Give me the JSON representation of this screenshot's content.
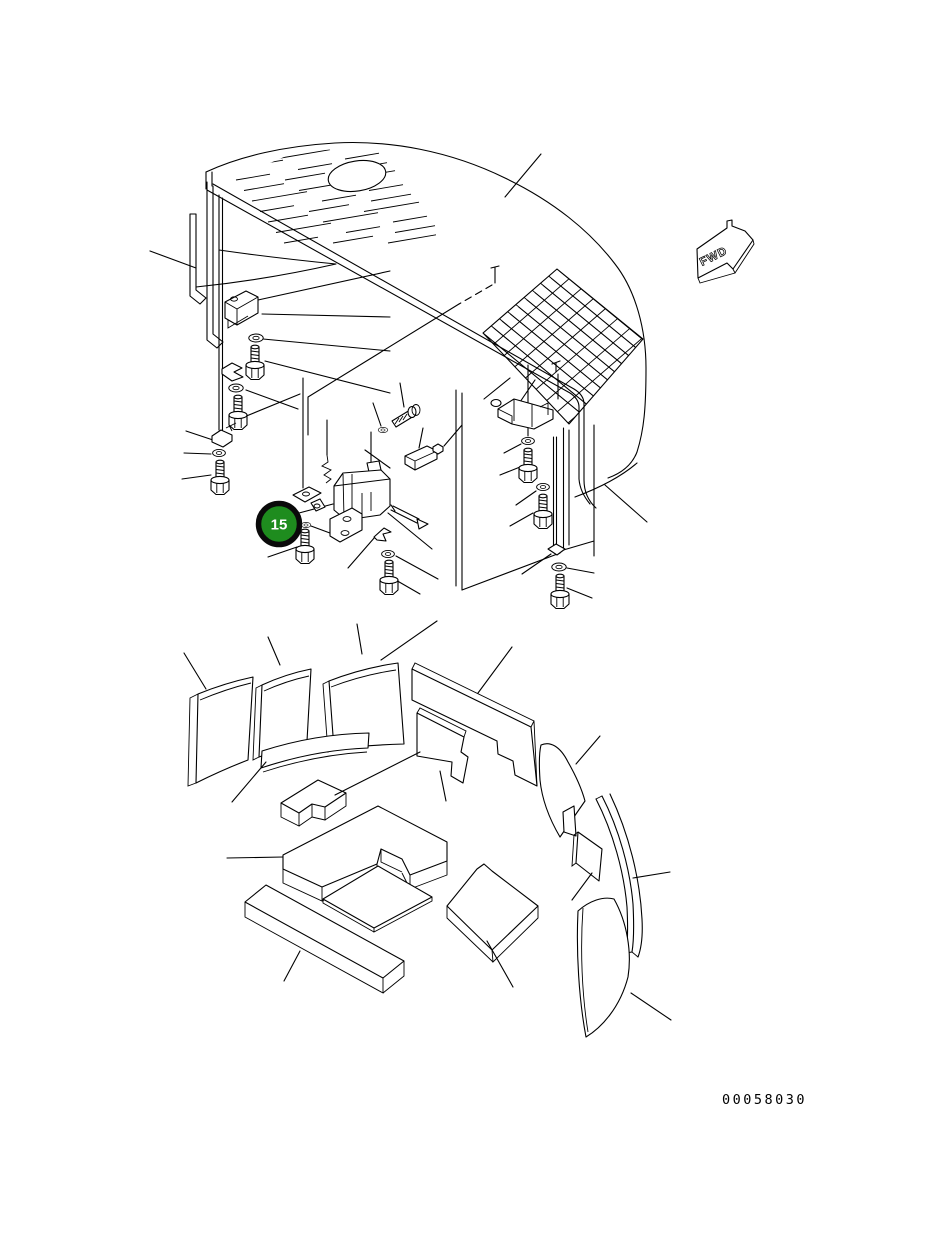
{
  "diagram": {
    "type": "exploded-parts-diagram",
    "callout": {
      "number": "15",
      "fill_color": "#1e8c1e",
      "ring_color": "#0a0a0a",
      "text_color": "#ffffff"
    },
    "direction_arrow": {
      "label": "FWD"
    },
    "part_number": "00058030",
    "line_color": "#000000",
    "background_color": "#ffffff"
  }
}
